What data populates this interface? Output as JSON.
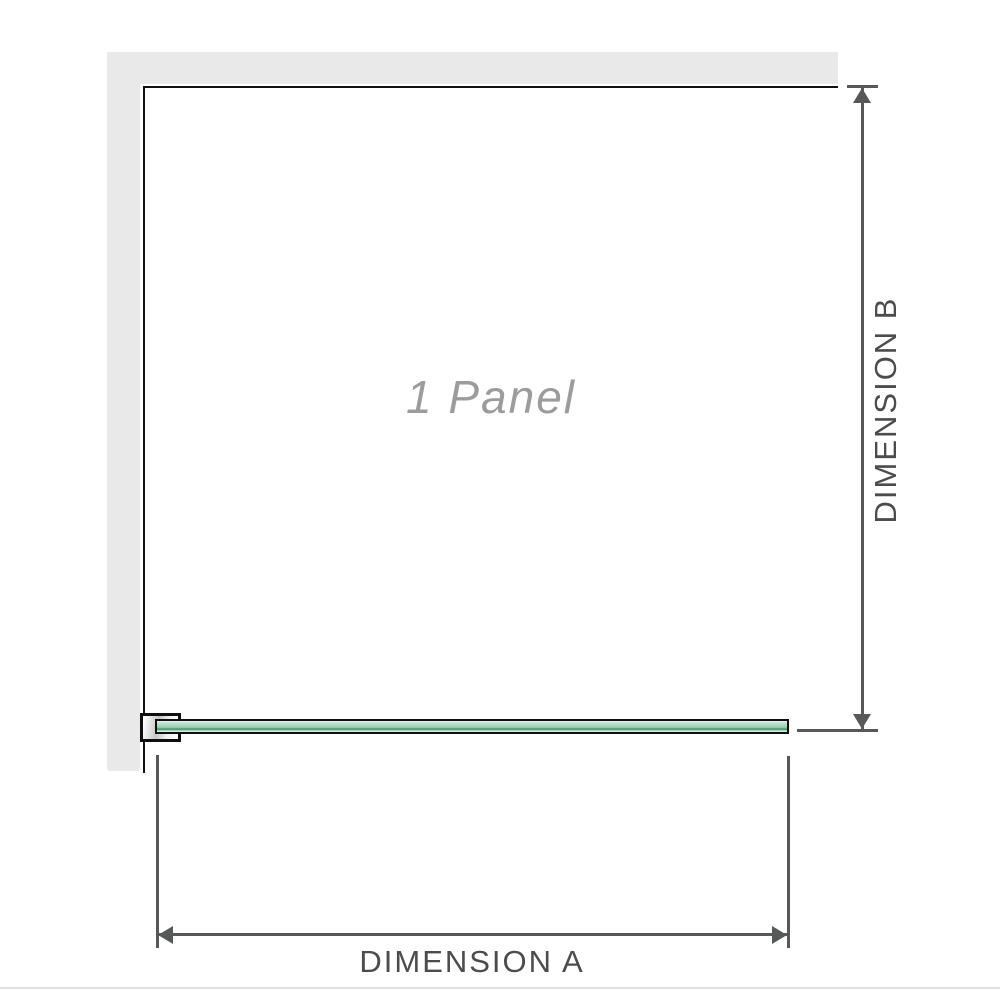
{
  "diagram": {
    "title": "shower panel dimension diagram",
    "panel_label": "1 Panel",
    "dimension_a": {
      "label": "DIMENSION A",
      "orientation": "horizontal"
    },
    "dimension_b": {
      "label": "DIMENSION B",
      "orientation": "vertical"
    },
    "panel_count": 1,
    "colors": {
      "wall_gray": "#e9e9e9",
      "panel_outline_black": "#121212",
      "dimension_gray": "#57585a",
      "label_text": "#4b4c4e",
      "panel_label_text": "#9c9c9c",
      "glass_green": "#a3d7bc",
      "glass_green_dark": "#4f8f6e",
      "glass_green_light": "#e8f5ee",
      "baseline_gray": "#dededa"
    }
  }
}
